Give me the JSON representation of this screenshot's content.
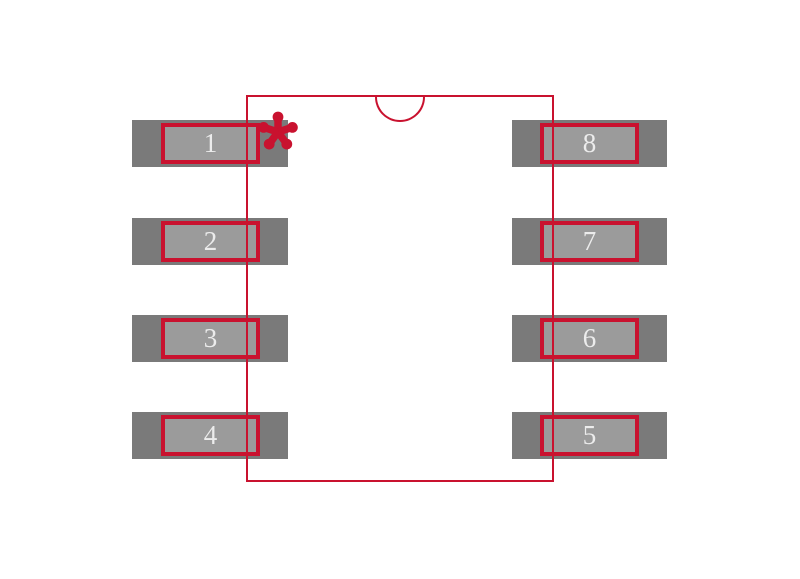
{
  "canvas": {
    "background": "#ffffff",
    "description": "8-pin dual-row package footprint preview (SOIC/DIP land pattern)"
  },
  "colors": {
    "outline_red": "#c9122f",
    "pad_gray": "#7a7a7a",
    "pad_inner_gray": "#9b9b9b",
    "pin_number_text": "#ececec"
  },
  "icons": {
    "pin1_marker": "asterisk-icon",
    "orientation_notch": "half-circle-notch"
  },
  "pins": {
    "left": [
      {
        "number": "1"
      },
      {
        "number": "2"
      },
      {
        "number": "3"
      },
      {
        "number": "4"
      }
    ],
    "right": [
      {
        "number": "8"
      },
      {
        "number": "7"
      },
      {
        "number": "6"
      },
      {
        "number": "5"
      }
    ]
  }
}
